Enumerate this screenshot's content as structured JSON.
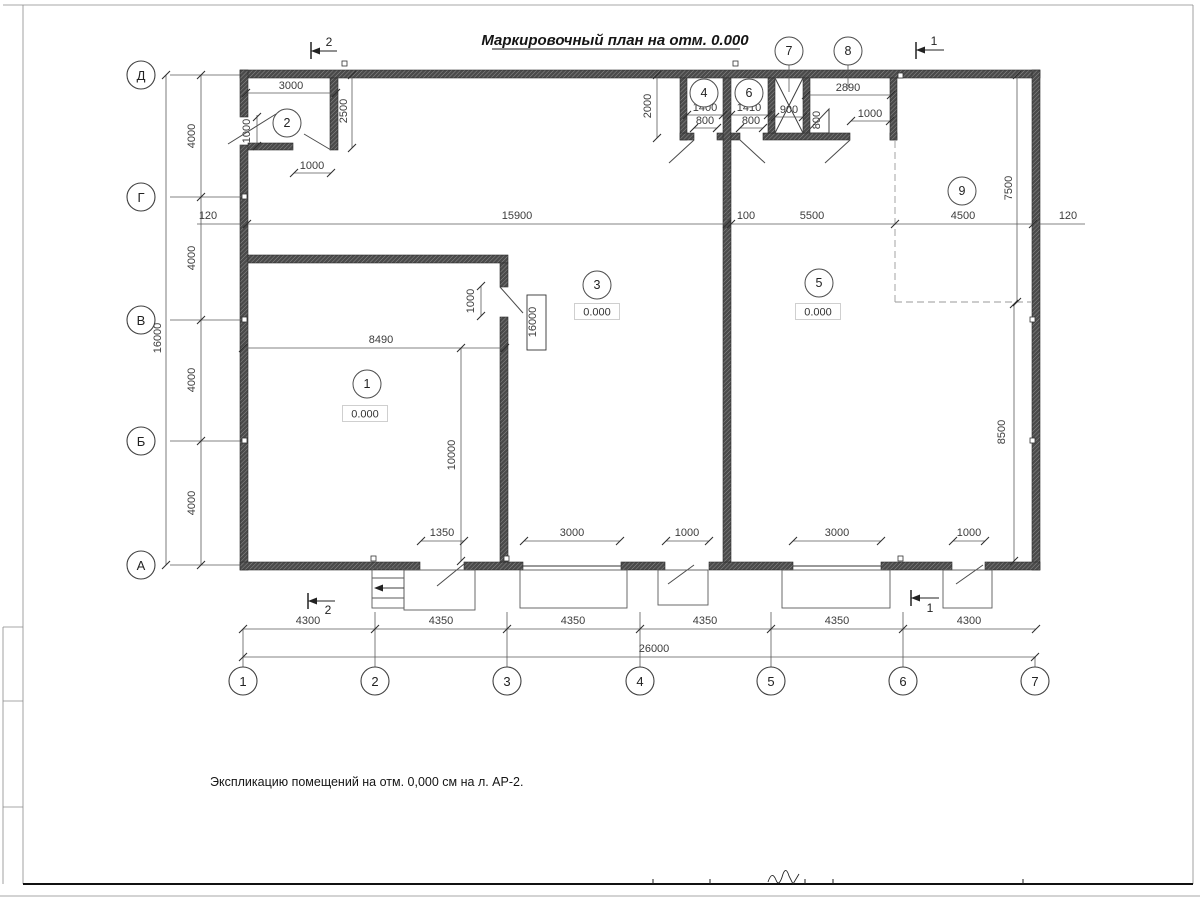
{
  "sheet": {
    "title": "Маркировочный план на отм. 0.000",
    "note": "Экспликацию помещений на отм. 0,000 см на л. АР-2."
  },
  "axes": {
    "bottom": [
      "1",
      "2",
      "3",
      "4",
      "5",
      "6",
      "7"
    ],
    "left": [
      "Д",
      "Г",
      "В",
      "Б",
      "А"
    ]
  },
  "sections": {
    "top_left": "2",
    "top_right": "1",
    "bottom_left": "2",
    "bottom_right": "1"
  },
  "rooms": {
    "r1": {
      "num": "1",
      "level": "0.000"
    },
    "r2": {
      "num": "2"
    },
    "r3": {
      "num": "3",
      "level": "0.000"
    },
    "r4": {
      "num": "4"
    },
    "r5": {
      "num": "5",
      "level": "0.000"
    },
    "r6": {
      "num": "6"
    },
    "r7": {
      "num": "7"
    },
    "r8": {
      "num": "8"
    },
    "r9": {
      "num": "9"
    }
  },
  "dims": {
    "room2_width": "3000",
    "room2_height": "2500",
    "room2_door_left": "1000",
    "room2_door_bottom": "1000",
    "toprooms_depth": "2000",
    "room4_width": "1400",
    "room4_door": "800",
    "room6_width": "1410",
    "room6_door": "800",
    "shaft_width": "900",
    "ramp_height": "800",
    "room8_width": "2890",
    "room8_door": "1000",
    "mid_left_offset": "120",
    "mid_span_left": "15900",
    "mid_gap": "100",
    "mid_span_mid": "5500",
    "mid_span_right": "4500",
    "mid_right_offset": "120",
    "room9_depth": "7500",
    "right_depth": "8500",
    "room1_width": "8490",
    "room1_depth": "10000",
    "room1_door": "1000",
    "panel_mark": "16000",
    "open_1350": "1350",
    "open_3000a": "3000",
    "open_1000a": "1000",
    "open_3000b": "3000",
    "open_1000b": "1000",
    "chain_bottom": [
      "4300",
      "4350",
      "4350",
      "4350",
      "4350",
      "4300"
    ],
    "total_width": "26000",
    "chain_left": [
      "4000",
      "4000",
      "4000",
      "4000"
    ],
    "total_height": "16000"
  }
}
